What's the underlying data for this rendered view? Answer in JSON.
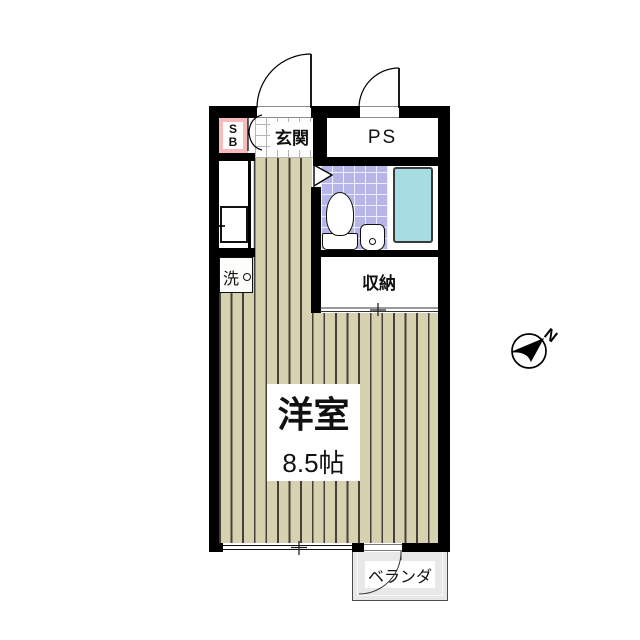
{
  "labels": {
    "entrance": "玄関",
    "pipe_space": "PS",
    "shoe_box_top": "S",
    "shoe_box_bottom": "B",
    "storage": "収納",
    "room_name": "洋室",
    "room_size": "8.5帖",
    "veranda": "ベランダ",
    "washer": "洗",
    "compass_north": "N"
  },
  "colors": {
    "wall": "#000000",
    "flooring": "#d6d2b0",
    "flooring-line": "#45413a",
    "tile": "#b6b6e8",
    "tile-line": "#eeeefc",
    "genkan-line": "#b5b5b5",
    "bathtub": "#a7dce2",
    "bathtub-border": "#3a3a3a",
    "accent-pink": "#f7babd",
    "veranda": "#e8e8e8"
  }
}
